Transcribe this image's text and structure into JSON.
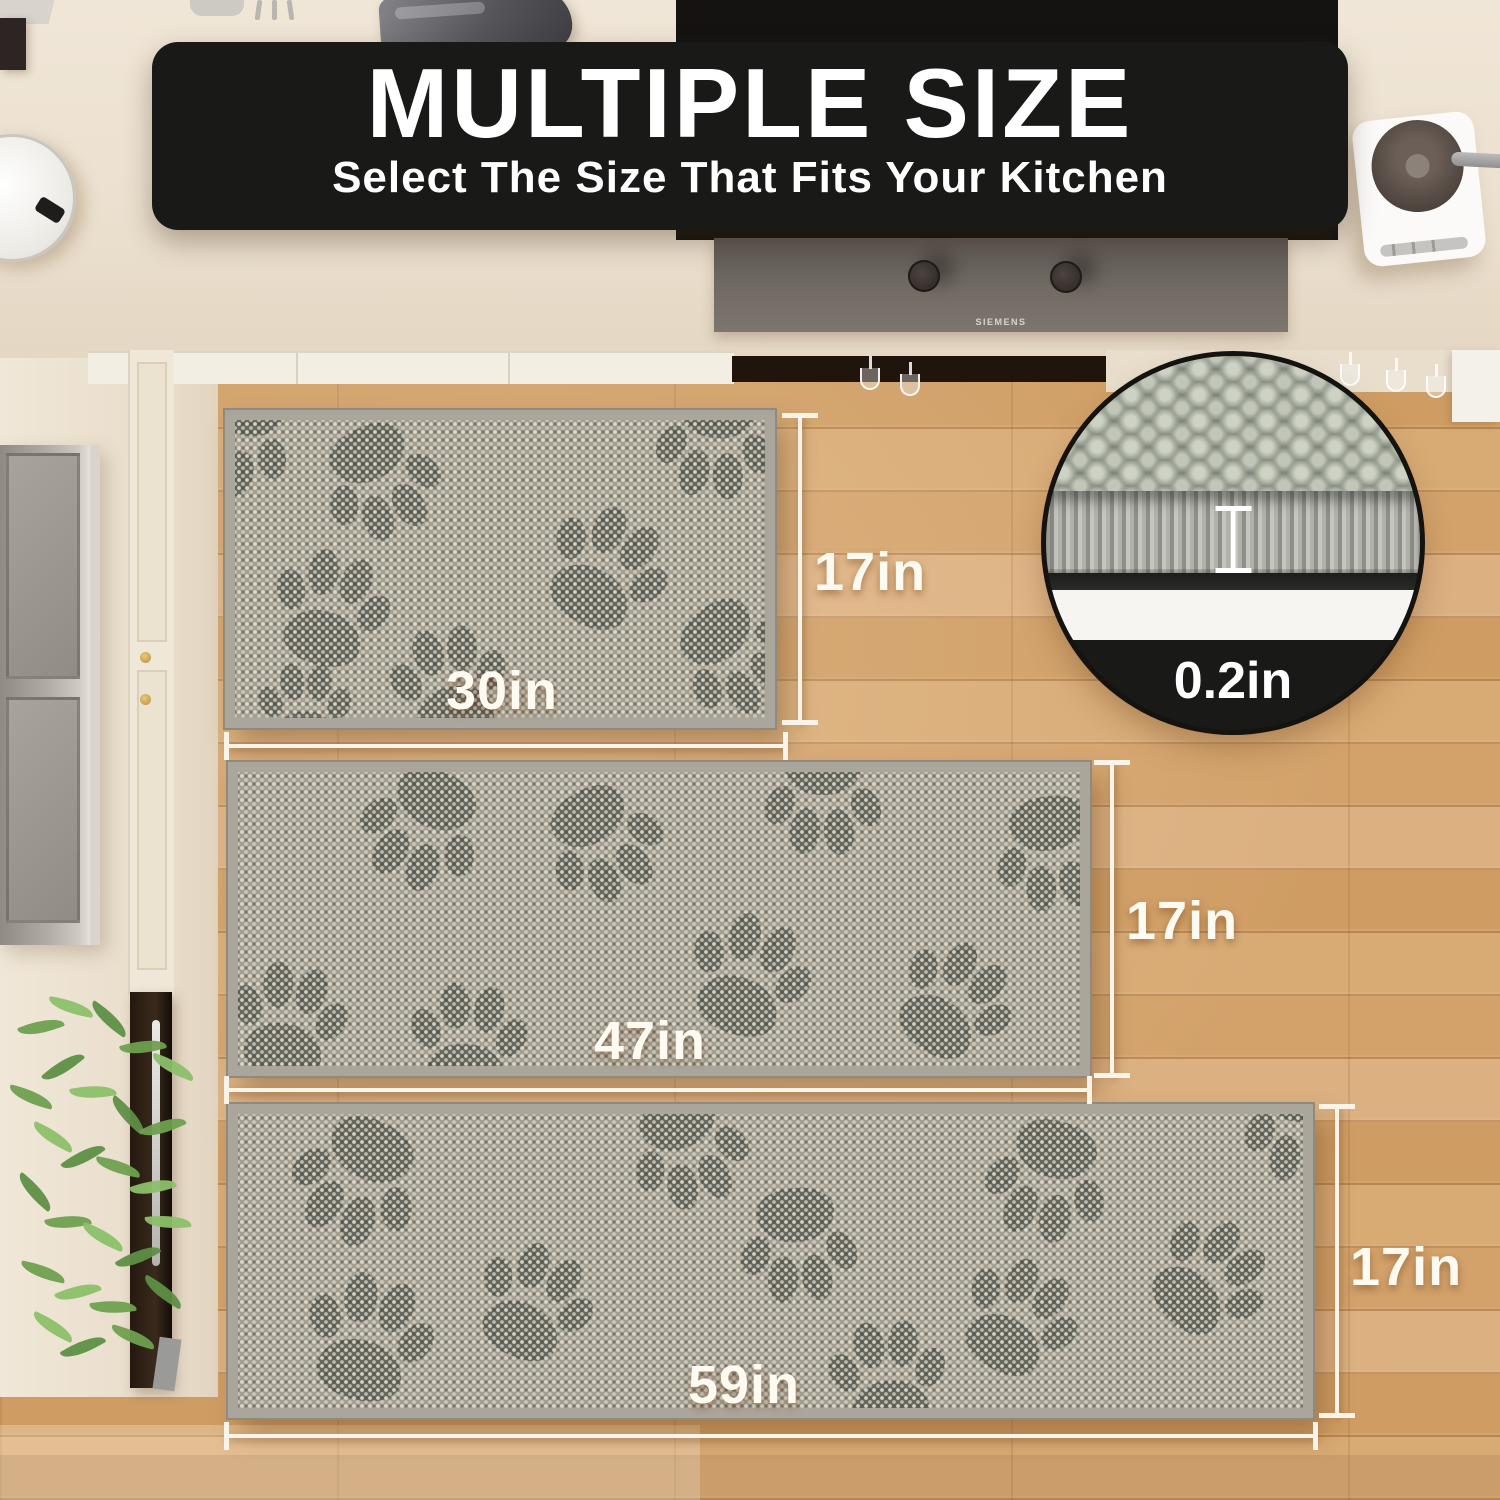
{
  "banner": {
    "title": "MULTIPLE SIZE",
    "subtitle": "Select The Size That Fits Your Kitchen"
  },
  "inset": {
    "thickness_label": "0.2in"
  },
  "cooktop": {
    "brand": "SIEMENS"
  },
  "mats": [
    {
      "name": "small",
      "width_label": "30in",
      "height_label": "17in"
    },
    {
      "name": "medium",
      "width_label": "47in",
      "height_label": "17in"
    },
    {
      "name": "large",
      "width_label": "59in",
      "height_label": "17in"
    }
  ],
  "colors": {
    "banner_bg": "#191918",
    "label_text": "#fdfaf1",
    "measure_line": "#f8f4e9",
    "mat_base": "#a49f93",
    "paw": "#575a53",
    "wood_floor": "#d2a06a",
    "countertop": "#ece1d0",
    "hood_gray": "#726b64"
  }
}
